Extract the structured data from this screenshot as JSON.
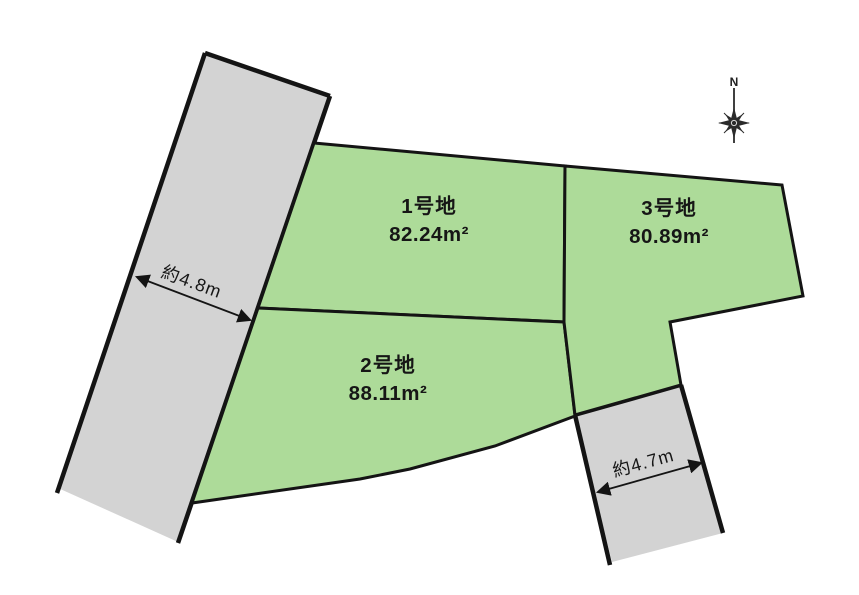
{
  "diagram": {
    "kind": "land-plot-subdivision-map",
    "background": "#ffffff"
  },
  "colors": {
    "parcel_fill": "#addb99",
    "road_fill": "#d3d3d3",
    "outline": "#141414",
    "text": "#161616"
  },
  "parcels": [
    {
      "name": "1号地",
      "area_label": "82.24m²"
    },
    {
      "name": "2号地",
      "area_label": "88.11m²"
    },
    {
      "name": "3号地",
      "area_label": "80.89m²"
    }
  ],
  "measurements": [
    {
      "label": "約4.8m"
    },
    {
      "label": "約4.7m"
    }
  ],
  "compass": {
    "north_label": "N"
  }
}
